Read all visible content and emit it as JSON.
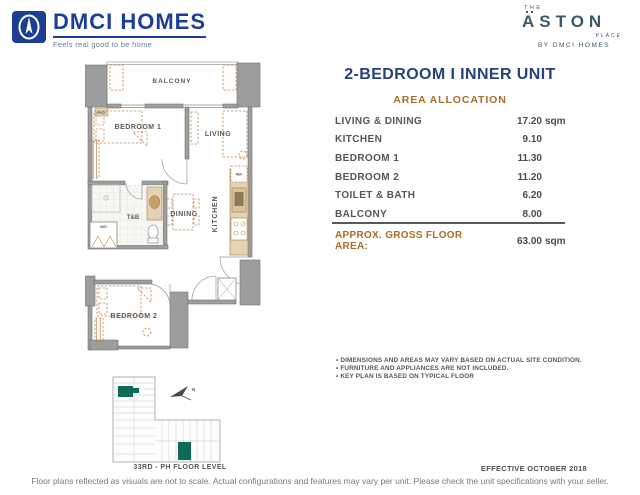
{
  "header": {
    "dmci": {
      "name": "DMCI HOMES",
      "tagline": "Feels real good to be home"
    },
    "aston": {
      "the": "THE",
      "name": "ASTON",
      "place": "PLACE",
      "by": "BY DMCI HOMES"
    }
  },
  "panel": {
    "title": "2-BEDROOM I INNER UNIT",
    "subtitle": "AREA ALLOCATION",
    "rows": [
      {
        "label": "LIVING & DINING",
        "value": "17.20",
        "unit": "sqm"
      },
      {
        "label": "KITCHEN",
        "value": "9.10",
        "unit": ""
      },
      {
        "label": "BEDROOM 1",
        "value": "11.30",
        "unit": ""
      },
      {
        "label": "BEDROOM 2",
        "value": "11.20",
        "unit": ""
      },
      {
        "label": "TOILET & BATH",
        "value": "6.20",
        "unit": ""
      },
      {
        "label": "BALCONY",
        "value": "8.00",
        "unit": ""
      }
    ],
    "total_label": "APPROX. GROSS FLOOR AREA:",
    "total_value": "63.00",
    "total_unit": "sqm",
    "notes": [
      "DIMENSIONS AND AREAS MAY VARY BASED ON ACTUAL SITE CONDITION.",
      "FURNITURE AND APPLIANCES ARE NOT INCLUDED.",
      "KEY PLAN IS BASED ON TYPICAL FLOOR"
    ]
  },
  "floorplan": {
    "rooms": {
      "balcony": "BALCONY",
      "bedroom1": "BEDROOM 1",
      "living": "LIVING",
      "tb": "T&B",
      "dining": "DINING",
      "kitchen": "KITCHEN",
      "bedroom2": "BEDROOM 2",
      "wd": "W/D",
      "ref": "REF",
      "wacu": "WACU"
    }
  },
  "keyplan": {
    "caption": "33RD - PH FLOOR LEVEL",
    "north": "N"
  },
  "footer": {
    "effective": "EFFECTIVE OCTOBER 2018",
    "disclaimer": "Floor plans reflected as visuals are not to scale. Actual configurations and features may vary per unit. Please check the unit specifications with your seller."
  },
  "colors": {
    "navy": "#27417b",
    "orange": "#a96d28",
    "dmci_blue": "#1c3e94",
    "aston_slate": "#3d5866",
    "keyplan_teal": "#0f6b58",
    "wall_gray": "#9d9d9d",
    "furniture_tan": "#b98a5a"
  }
}
